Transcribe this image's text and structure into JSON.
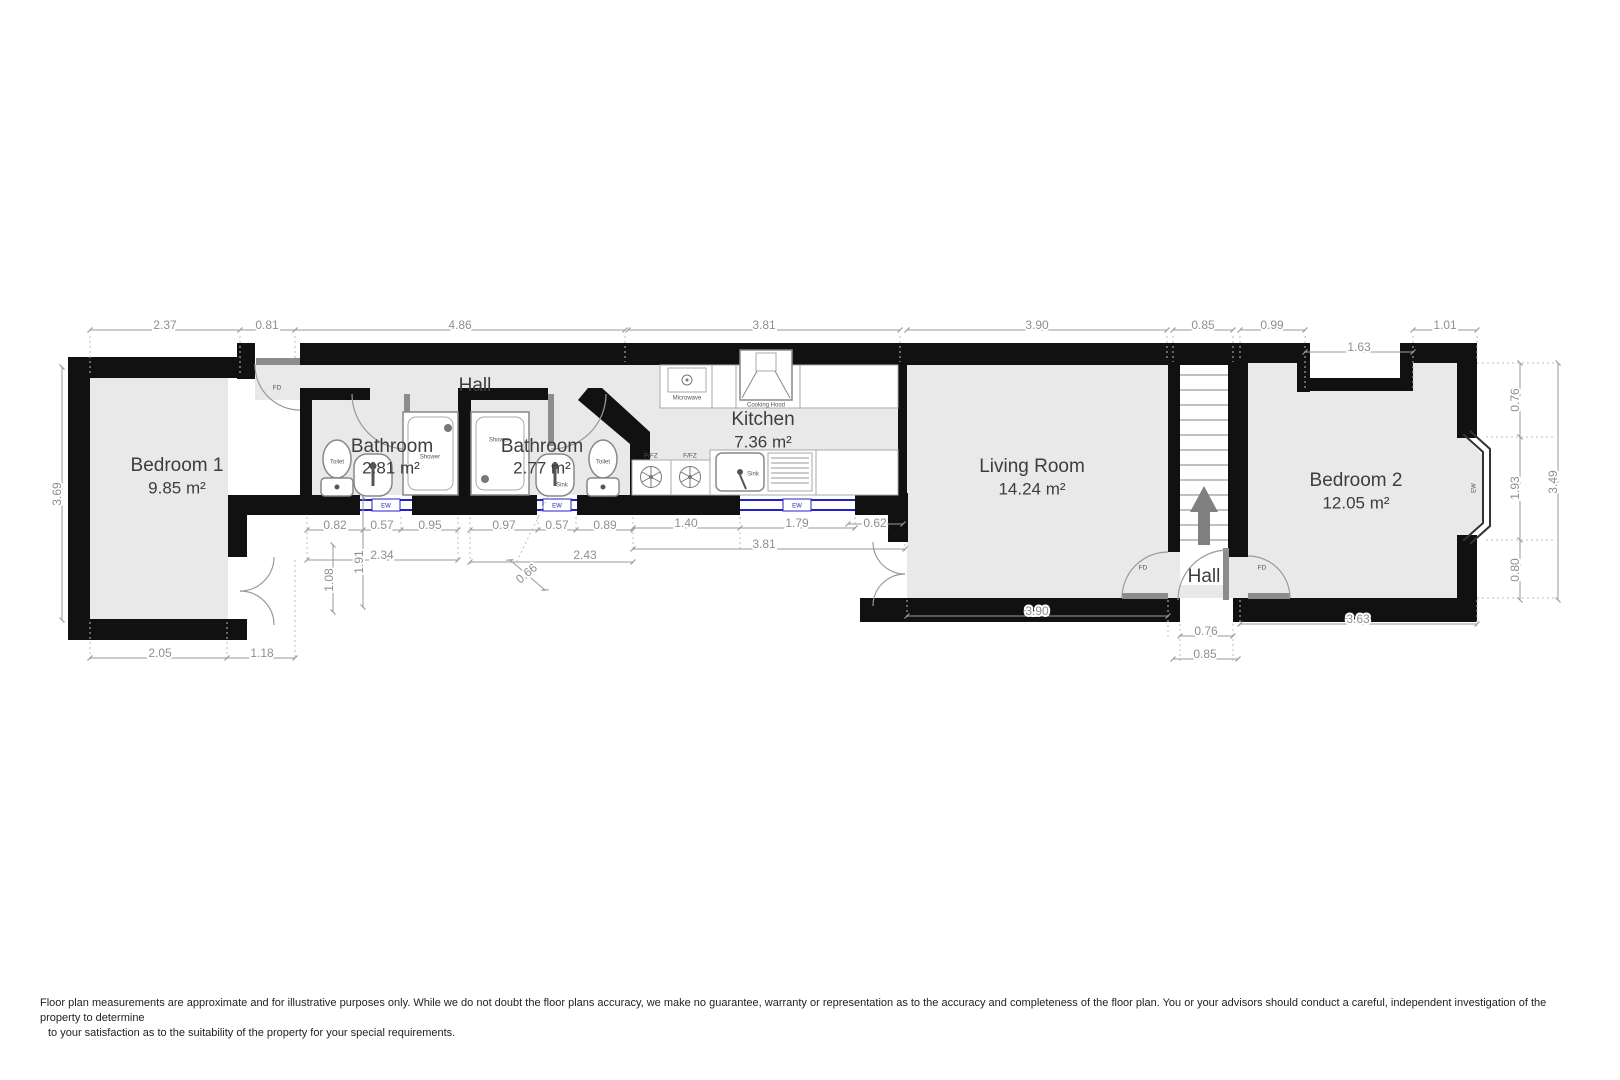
{
  "plan": {
    "rooms": {
      "bedroom1": {
        "name": "Bedroom 1",
        "area": "9.85 m²"
      },
      "hall": {
        "name": "Hall"
      },
      "bathroom1": {
        "name": "Bathroom",
        "area": "2.81 m²"
      },
      "bathroom2": {
        "name": "Bathroom",
        "area": "2.77 m²"
      },
      "kitchen": {
        "name": "Kitchen",
        "area": "7.36 m²"
      },
      "living_room": {
        "name": "Living Room",
        "area": "14.24 m²"
      },
      "entrance_hall": {
        "name": "Hall"
      },
      "bedroom2": {
        "name": "Bedroom 2",
        "area": "12.05 m²"
      }
    },
    "fixtures": {
      "toilet": "Toilet",
      "shower": "Shower",
      "sink": "Sink",
      "microwave": "Microwave",
      "cooking_hood": "Cooking Hood",
      "fridge_freezer": "F/FZ",
      "fire_door": "FD",
      "window": "EW"
    },
    "dims": {
      "bed1_width": "2.37",
      "hall_door": "0.81",
      "hall_width": "4.86",
      "kitchen_top": "3.81",
      "living_top": "3.90",
      "stairs_top": "0.85",
      "bed2_top_left": "0.99",
      "bed2_recess": "1.63",
      "bed2_top_right": "1.01",
      "bed1_height": "3.69",
      "bath1_a": "0.82",
      "bath1_b": "0.57",
      "bath1_c": "0.95",
      "bath1_w": "2.34",
      "bath2_a": "0.97",
      "bath2_b": "0.57",
      "bath2_c": "0.89",
      "bath2_w": "2.43",
      "bath2_diag": "0.66",
      "bath_height": "1.91",
      "bed1_door_height": "1.08",
      "kitchen_a": "1.40",
      "kitchen_b": "1.79",
      "kitchen_c": "0.62",
      "kitchen_bottom": "3.81",
      "bed1_bottom_a": "2.05",
      "bed1_bottom_b": "1.18",
      "living_bottom": "3.90",
      "entry_door": "0.76",
      "entry_total": "0.85",
      "bed2_bottom": "3.63",
      "bed2_right_a": "0.76",
      "bed2_right_b": "1.93",
      "bed2_right_c": "0.80",
      "bed2_right_total": "3.49"
    },
    "colors": {
      "wall": "#111111",
      "floor": "#e9e9e9",
      "dimension": "#8f8f8f",
      "window_marker": "#2222cc",
      "door_leaf": "#8c8c8c"
    }
  },
  "disclaimer": {
    "line1": "Floor plan measurements are approximate and for illustrative purposes only. While we do not doubt the floor plans accuracy, we make no guarantee, warranty or representation as to the accuracy and completeness of the floor plan. You or your advisors should conduct a careful, independent investigation of the",
    "line2": "property to determine",
    "line3": "to your satisfaction as to the suitability of the property for your special requirements."
  }
}
